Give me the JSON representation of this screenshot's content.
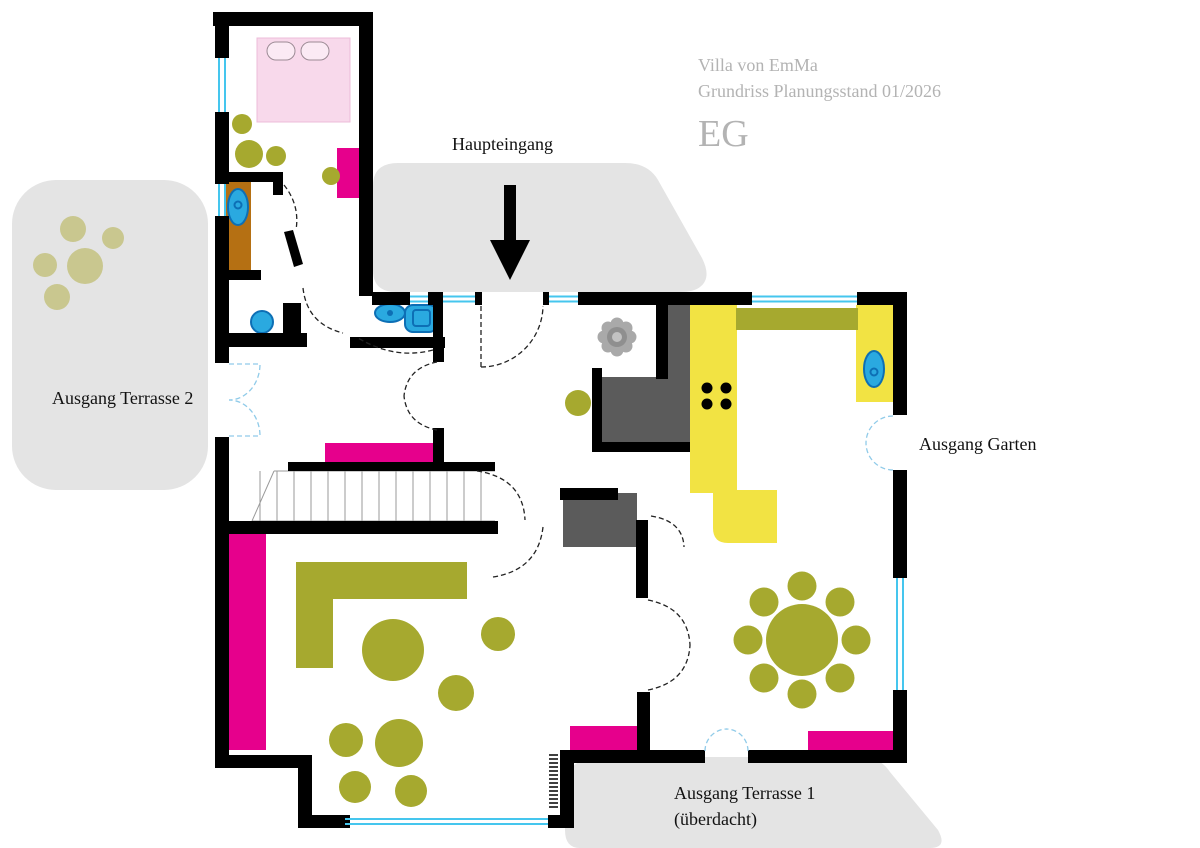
{
  "header": {
    "project": "Villa von EmMa",
    "subtitle": "Grundriss Planungsstand 01/2026",
    "floor_label": "EG"
  },
  "annotations": {
    "main_entrance": "Haupteingang",
    "exit_terrace_2": "Ausgang Terrasse 2",
    "exit_garden": "Ausgang Garten",
    "exit_terrace_1_line1": "Ausgang Terrasse 1",
    "exit_terrace_1_line2": "(überdacht)"
  },
  "colors": {
    "magenta": "#e6008c",
    "olive": "#a6a92f",
    "olive_muted": "#c9c78f",
    "yellow": "#f2e343",
    "gray_area": "#e4e4e4",
    "gray_dark": "#5b5b5b",
    "blue": "#2aa9e0",
    "blue_dark": "#0d6fb5",
    "brown": "#b57013",
    "bed_pink": "#f8d9eb",
    "bed_stroke": "#edbcd9",
    "window_cyan": "#45c6ee",
    "door_dash": "#90cbe9",
    "title_gray": "#b3b3b3",
    "wall_black": "#000000"
  }
}
